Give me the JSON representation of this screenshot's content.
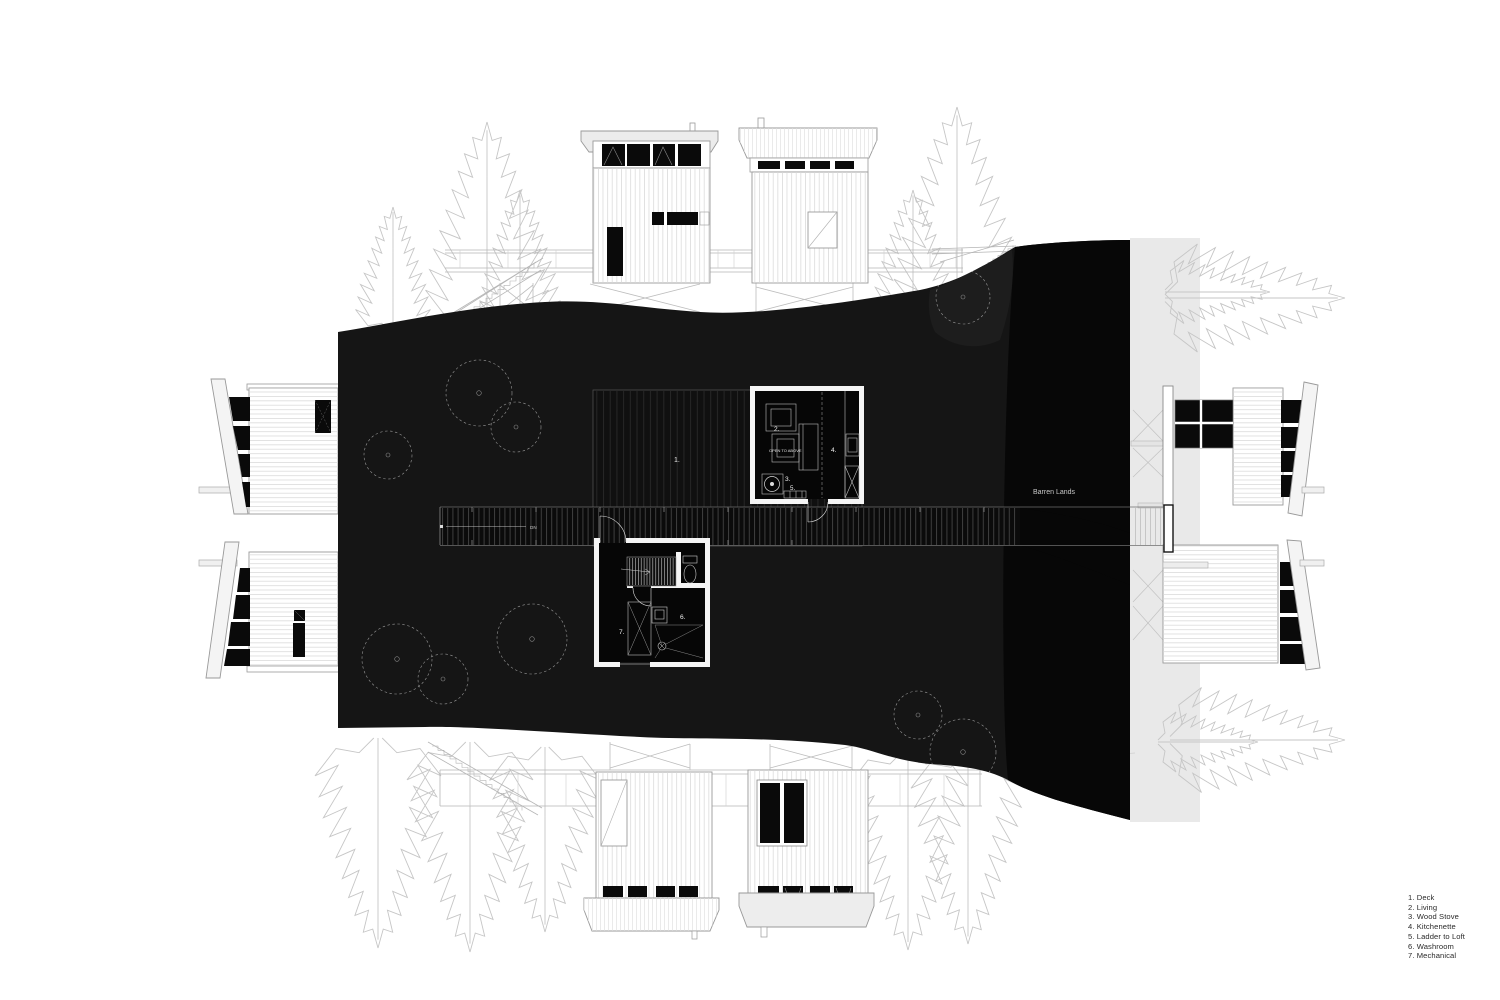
{
  "title": "Cabin site plan with unfolded elevations",
  "plan": {
    "site_label": "Barren Lands",
    "deck_label": "1.",
    "living_label": "2.",
    "stove_label": "3.",
    "kitchenette_label": "4.",
    "ladder_label": "5.",
    "washroom_label": "6.",
    "mechanical_label": "7.",
    "open_above_label": "OPEN TO ABOVE",
    "walkway_direction_label": "DN"
  },
  "legend": {
    "items": [
      "1. Deck",
      "2. Living",
      "3. Wood Stove",
      "4. Kitchenette",
      "5. Ladder to Loft",
      "6. Washroom",
      "7. Mechanical"
    ]
  },
  "colors": {
    "rock": "#151515",
    "rock_dark": "#070707",
    "paper": "#ffffff",
    "sketch_line": "#c6c6c6",
    "window_black": "#0a0a0a",
    "ground_strip": "#e9e9e9"
  }
}
